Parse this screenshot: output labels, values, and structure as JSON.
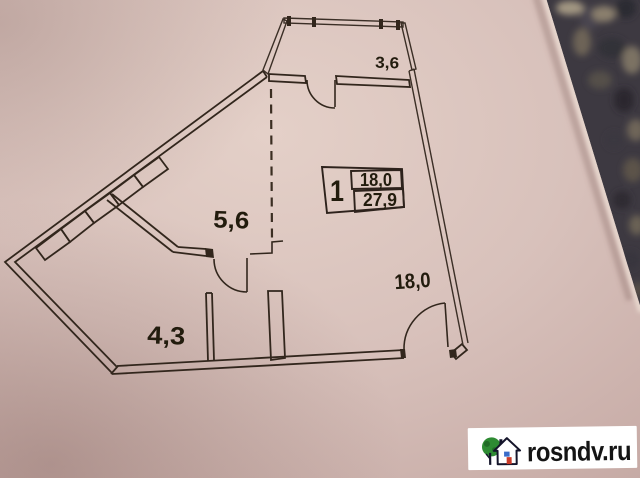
{
  "plan": {
    "labels": {
      "balcony": "3,6",
      "niche": "5,6",
      "hall": "4,3",
      "room": "18,0"
    },
    "table": {
      "number": "1",
      "living_area": "18,0",
      "total_area": "27,9"
    }
  },
  "watermark": {
    "site": "rosndv.ru",
    "icons": {
      "tree": "tree-icon",
      "house": "house-icon"
    }
  },
  "colors": {
    "paper": "#d8c1bb",
    "ink": "#32281f",
    "carpet_dark": "#3d3941",
    "watermark_bg": "#ffffff",
    "logo_green": "#2e8b33",
    "logo_red": "#c93a28",
    "logo_blue": "#3a6cc8",
    "logo_ink": "#14142a",
    "text": "#141414"
  }
}
